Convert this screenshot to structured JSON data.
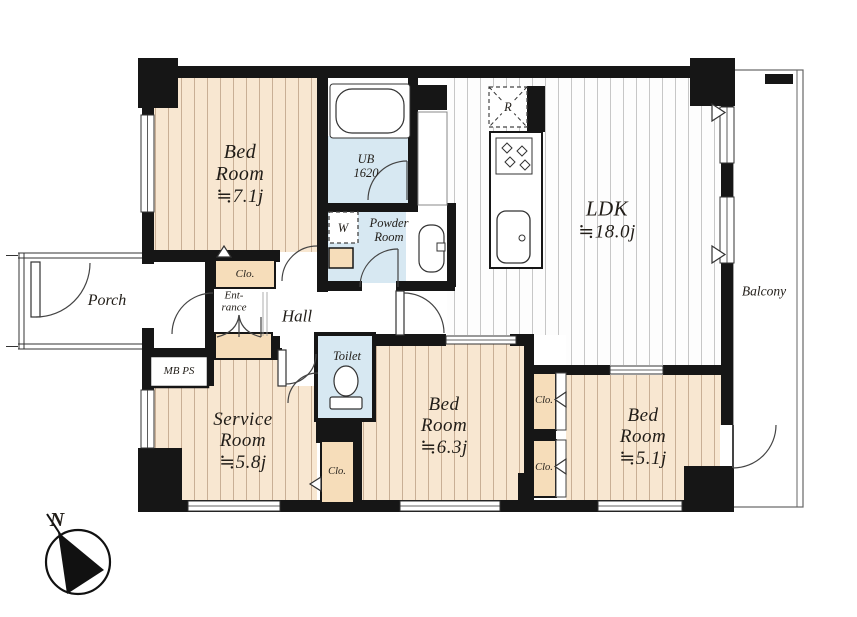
{
  "colors": {
    "floor_peach": "#f8e7d1",
    "floor_stripe": "#c9af95",
    "closet_fill": "#f6ddba",
    "wet_area": "#d7e8f2",
    "ldk_floor": "#fdfdfd",
    "ldk_stripe": "#cccccc",
    "wall": "#161616",
    "text": "#211d18"
  },
  "rooms": {
    "bedroom_71": {
      "lines": [
        "Bed",
        "Room",
        "≒7.1j"
      ]
    },
    "bedroom_63": {
      "lines": [
        "Bed",
        "Room",
        "≒6.3j"
      ]
    },
    "bedroom_51": {
      "lines": [
        "Bed",
        "Room",
        "≒5.1j"
      ]
    },
    "service_room": {
      "lines": [
        "Service",
        "Room",
        "≒5.8j"
      ]
    },
    "ldk": {
      "lines": [
        "LDK",
        "≒18.0j"
      ]
    },
    "unit_bath": {
      "lines": [
        "UB",
        "1620"
      ]
    },
    "powder_room": {
      "lines": [
        "Powder",
        "Room"
      ]
    },
    "entrance": {
      "lines": [
        "Ent-",
        "rance"
      ]
    },
    "toilet": {
      "label": "Toilet"
    },
    "hall": {
      "label": "Hall"
    },
    "porch": {
      "label": "Porch"
    },
    "balcony": {
      "label": "Balcony"
    },
    "meter_pipe_space": {
      "label": "MB PS"
    }
  },
  "labels": {
    "closet": "Clo.",
    "washer": "W",
    "refrigerator": "R",
    "north": "N"
  }
}
